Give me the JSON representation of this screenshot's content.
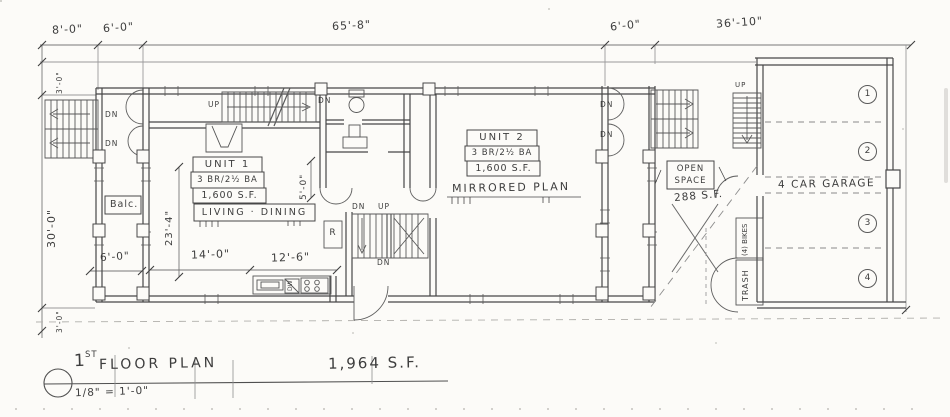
{
  "sheet": {
    "background": "#fcfbf8",
    "ink": "#4a4a4a"
  },
  "title_block": {
    "number": "1",
    "number_suffix": "ST",
    "title": "FLOOR PLAN",
    "scale": "1/8\" = 1'-0\"",
    "total_area": "1,964 S.F."
  },
  "dims": {
    "top": [
      "8'-0\"",
      "6'-0\"",
      "65'-8\"",
      "6'-0\"",
      "36'-10\""
    ],
    "left_main": "30'-0\"",
    "left_top": "3'-0\"",
    "left_bottom": "3'-0\"",
    "living_depth": "23'-4\"",
    "stair_hall": "5'-0\"",
    "balcony": "6'-0\"",
    "living_width": "14'-0\"",
    "kitchen_width": "12'-6\""
  },
  "unit1": {
    "name": "UNIT 1",
    "config": "3 BR/2½ BA",
    "area": "1,600 S.F.",
    "room": "LIVING · DINING",
    "balcony": "Balc.",
    "fridge": "R",
    "dishwasher": "DW"
  },
  "unit2": {
    "name": "UNIT 2",
    "config": "3 BR/2½ BA",
    "area": "1,600 S.F.",
    "note": "MIRRORED PLAN"
  },
  "open_space": {
    "word1": "OPEN",
    "word2": "SPACE",
    "area": "288 S.F."
  },
  "garage": {
    "name": "4 CAR GARAGE",
    "stalls": [
      "1",
      "2",
      "3",
      "4"
    ],
    "bikes": "(4) BIKES",
    "trash": "TRASH"
  },
  "stairs": {
    "up": "UP",
    "dn": "DN"
  }
}
